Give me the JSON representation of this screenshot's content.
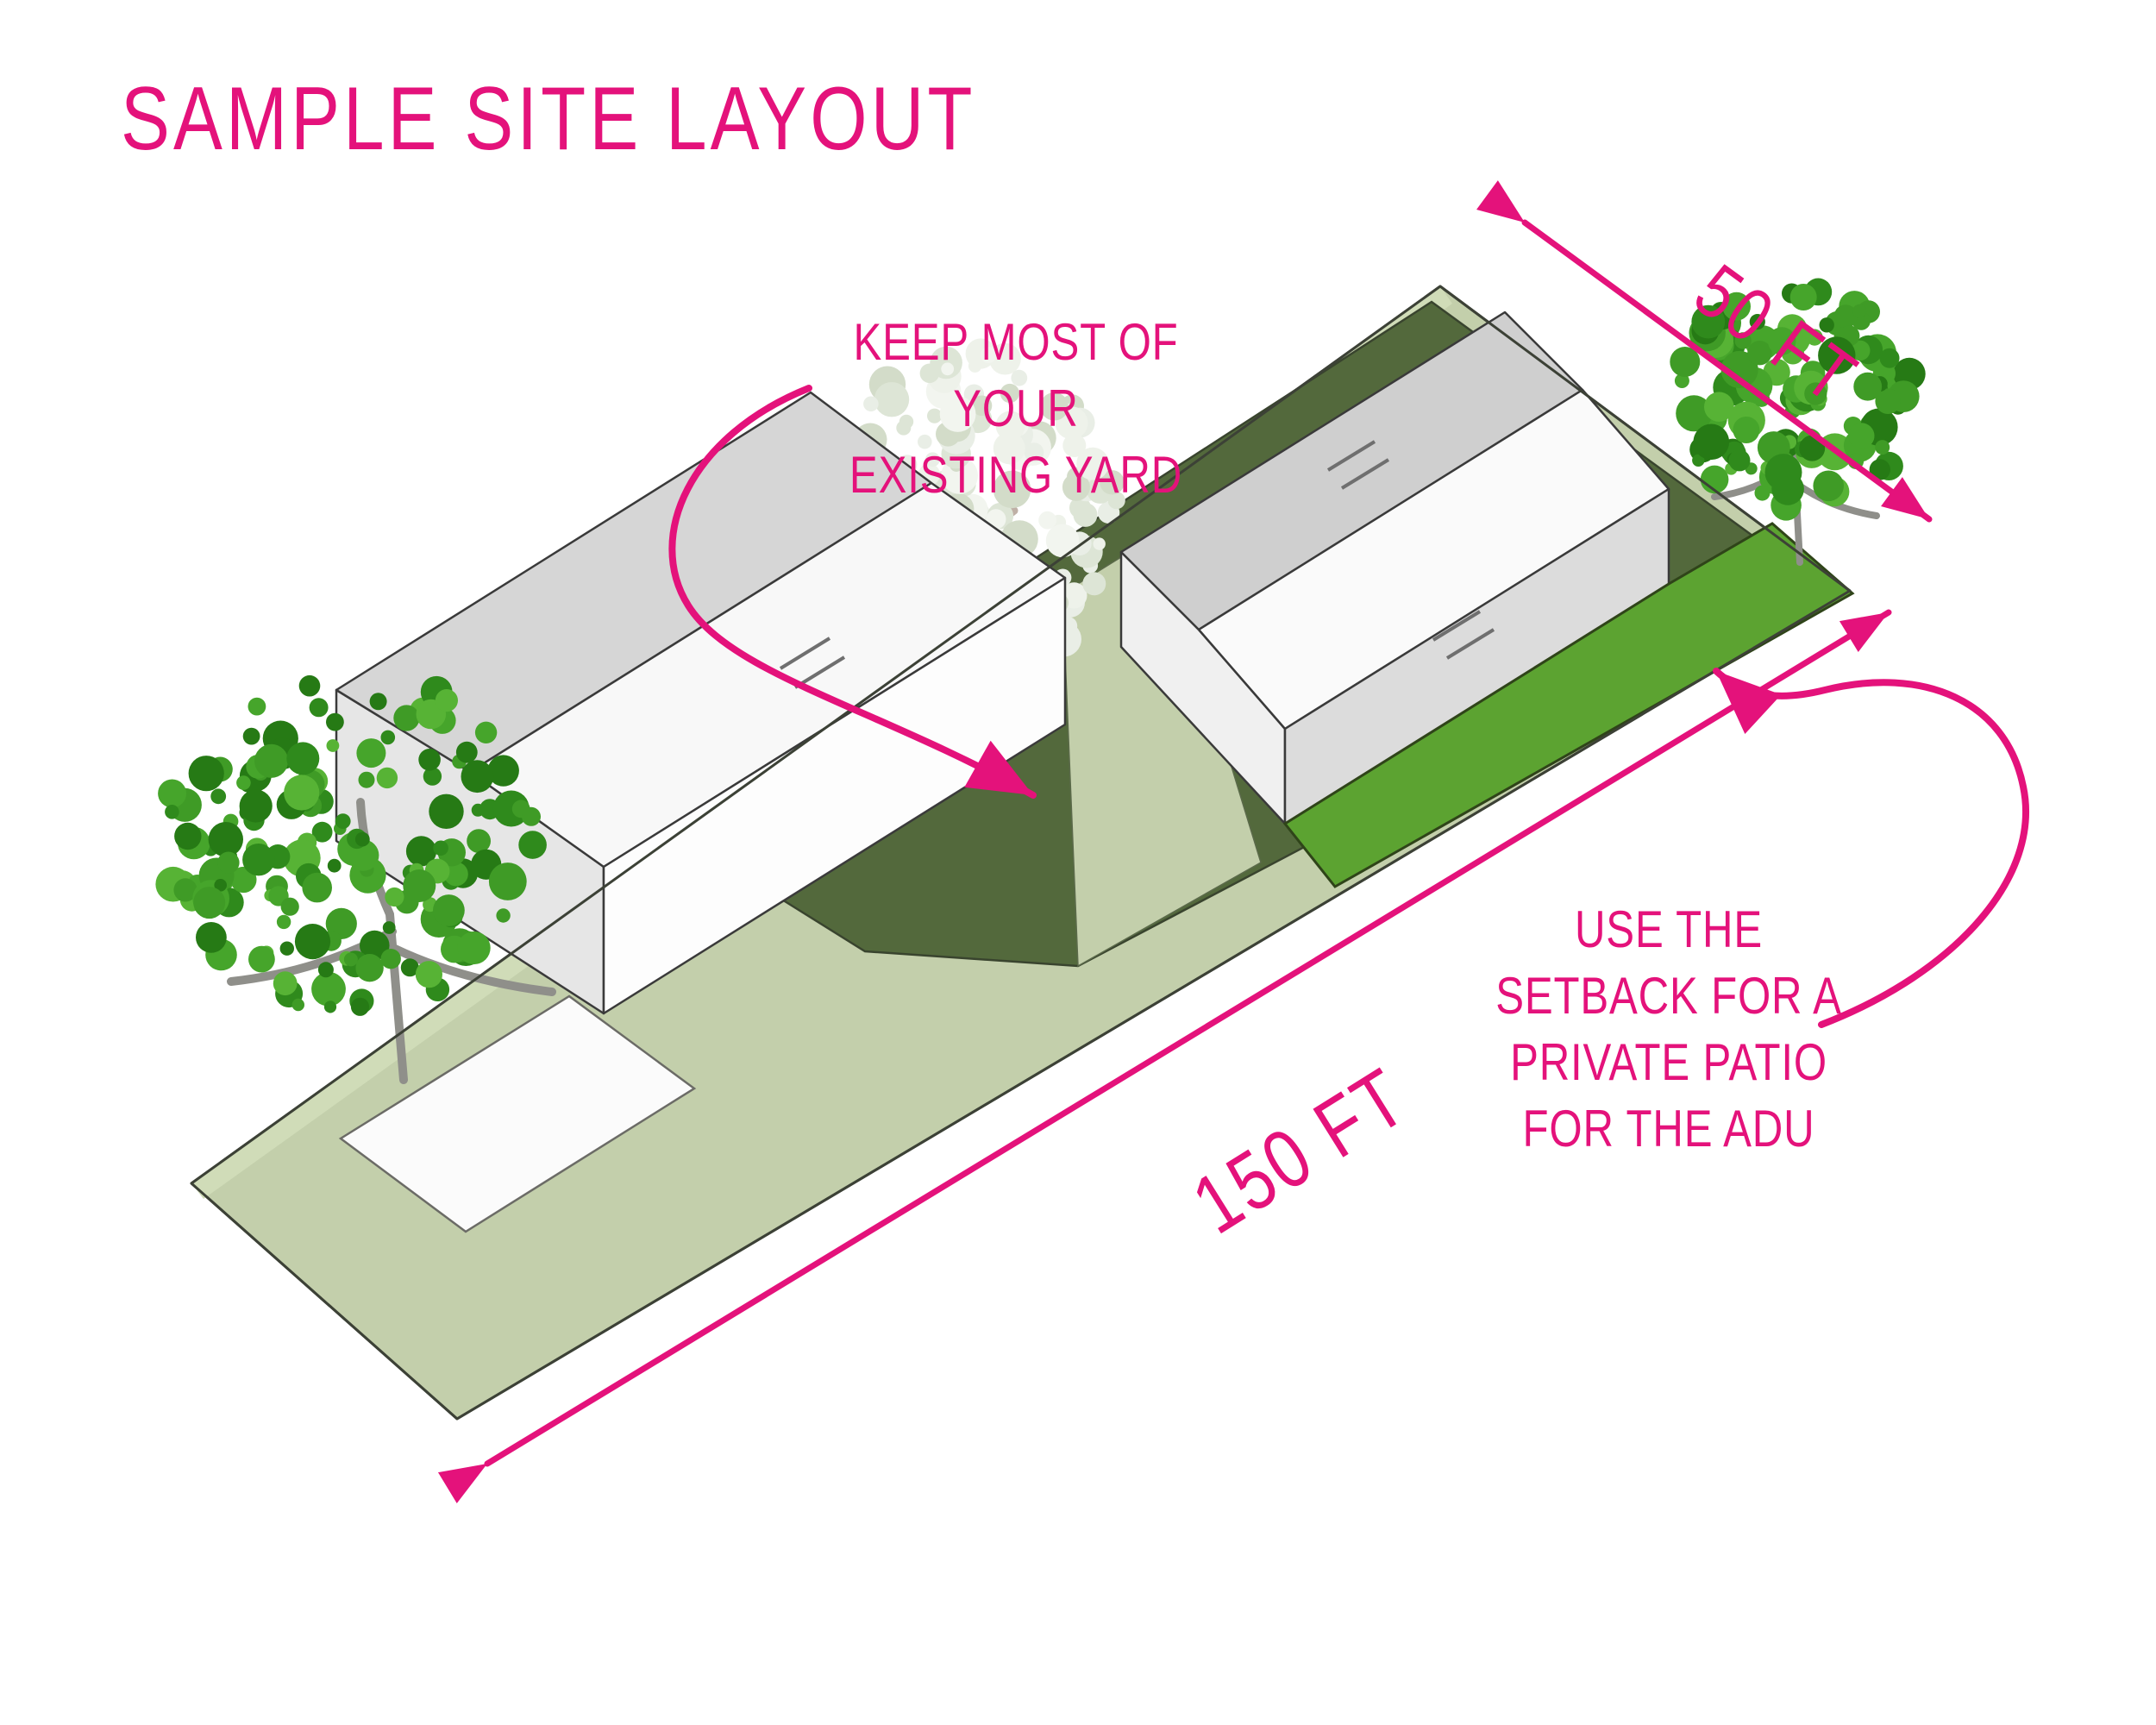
{
  "title": {
    "text": "SAMPLE SITE LAYOUT"
  },
  "annotations": {
    "keep_yard": {
      "lines": [
        "KEEP MOST OF YOUR",
        "EXISTING YARD"
      ]
    },
    "setback_patio": {
      "lines": [
        "USE THE",
        "SETBACK FOR A",
        "PRIVATE PATIO",
        "FOR THE ADU"
      ]
    }
  },
  "dimensions": {
    "lot_width": {
      "label": "50 FT"
    },
    "lot_length": {
      "label": "150 FT"
    }
  },
  "site_elements": [
    "lot",
    "front-lawn",
    "backyard",
    "walkway",
    "setback-patio-strip",
    "main-house",
    "adu",
    "driveway",
    "front-yard-tree",
    "backyard-tree",
    "corner-tree"
  ],
  "colors": {
    "accent_pink": "#E4127B",
    "lawn": "#C3CFAB",
    "lawn_light": "#D0DCB8",
    "yard_dark": "#53693C",
    "patio_green": "#5CA331",
    "tree_green": "#3F9B26",
    "roof_gray": "#D6D6D6",
    "wall_white": "#FDFDFD"
  }
}
